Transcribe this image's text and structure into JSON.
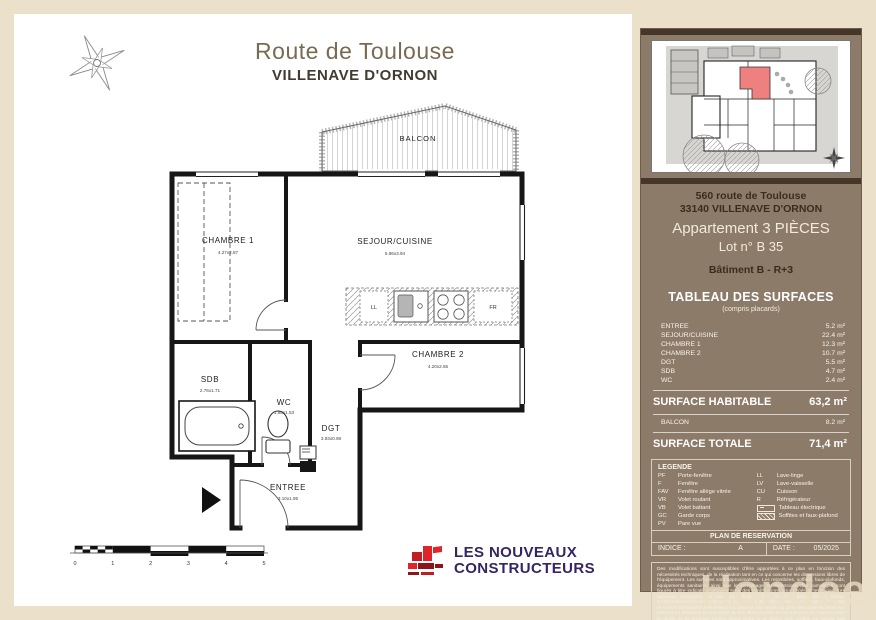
{
  "page": {
    "title": "Route de Toulouse",
    "subtitle": "VILLENAVE D'ORNON"
  },
  "plan": {
    "balcon_label": "BALCON",
    "rooms": [
      {
        "name": "CHAMBRE 1",
        "dim": "4.27x2.87"
      },
      {
        "name": "SEJOUR/CUISINE",
        "dim": "5.96x3.94"
      },
      {
        "name": "CHAMBRE 2",
        "dim": "4.20x2.55"
      },
      {
        "name": "SDB",
        "dim": "2.76x1.71"
      },
      {
        "name": "WC",
        "dim": "1.88x1.53"
      },
      {
        "name": "DGT",
        "dim": "3.93x0.98"
      },
      {
        "name": "ENTREE",
        "dim": "3.10x1.95"
      }
    ],
    "kitchen": {
      "ll": "LL",
      "fr": "FR"
    },
    "scale_ticks": [
      "0",
      "1",
      "2",
      "3",
      "4",
      "5"
    ]
  },
  "logo": {
    "line1": "LES NOUVEAUX",
    "line2": "CONSTRUCTEURS"
  },
  "sidebar": {
    "address_line1": "560 route de Toulouse",
    "address_line2": "33140 VILLENAVE D'ORNON",
    "apartment_type": "Appartement  3 PIÈCES",
    "lot": "Lot n° B 35",
    "building": "Bâtiment B - R+3",
    "surfaces_title": "TABLEAU DES SURFACES",
    "surfaces_subtitle": "(compris placards)",
    "surface_rows": [
      {
        "label": "ENTREE",
        "value": "5.2  m²"
      },
      {
        "label": "SEJOUR/CUISINE",
        "value": "22.4  m²"
      },
      {
        "label": "CHAMBRE 1",
        "value": "12.3  m²"
      },
      {
        "label": "CHAMBRE 2",
        "value": "10.7  m²"
      },
      {
        "label": "DGT",
        "value": "5.5  m²"
      },
      {
        "label": "SDB",
        "value": "4.7  m²"
      },
      {
        "label": "WC",
        "value": "2.4  m²"
      }
    ],
    "habitable_label": "SURFACE HABITABLE",
    "habitable_value": "63,2 m²",
    "balcon_label": "BALCON",
    "balcon_value": "8.2  m²",
    "totale_label": "SURFACE TOTALE",
    "totale_value": "71,4 m²",
    "legend": {
      "title": "LEGENDE",
      "left": [
        {
          "abbr": "PF",
          "label": "Porte-fenêtre"
        },
        {
          "abbr": "F",
          "label": "Fenêtre"
        },
        {
          "abbr": "FAV",
          "label": "Fenêtre allège vitrée"
        },
        {
          "abbr": "VR",
          "label": "Volet roulant"
        },
        {
          "abbr": "VB",
          "label": "Volet battant"
        },
        {
          "abbr": "GC",
          "label": "Garde corps"
        },
        {
          "abbr": "PV",
          "label": "Pare vue"
        }
      ],
      "right": [
        {
          "abbr": "LL",
          "label": "Lave-linge"
        },
        {
          "abbr": "LV",
          "label": "Lave-vaisselle"
        },
        {
          "abbr": "CU",
          "label": "Cuisson"
        },
        {
          "abbr": "R",
          "label": "Réfrigérateur"
        }
      ],
      "tableau_label": "Tableau électrique",
      "soffites_label": "Soffites et faux-plafond"
    },
    "reservation": {
      "title": "PLAN DE RESERVATION",
      "indice_label": "INDICE :",
      "indice_value": "A",
      "date_label": "DATE :",
      "date_value": "05/2025"
    },
    "disclaimer": "Des modifications sont susceptibles d'être apportées à ce plan en fonction des nécessités techniques, de la réalisation tant en ce qui concerne les dimensions libres de l'équipement. Les surfaces sont approximatives. Les retombées, soffites, faux-plafonds, équipements sanitaires ainsi que le calepinage et dimensions des carrelages sont figurés à titre indicatif et peuvent subir des modifications pour impératif technique. Les appareils ménagers ne sont pas fournis. Les volets roulants seront prévus conformément à la notice de vente. Les coffres de volet roulant ne sont pas représentés et seront débordants à l'intérieur. La hauteur des seuils au droit des porte-fenêtres sur balcons ou terrasses pourra varier de 5 à 35cm à partir du sol intérieur. La hauteur entre le jardin et la terrasse pourra varier entre 0 et 50cm. Les jardins ne seront pas nécessairement plats et pourront comporter des talus et des pentes."
  },
  "watermark": "Hondee"
}
